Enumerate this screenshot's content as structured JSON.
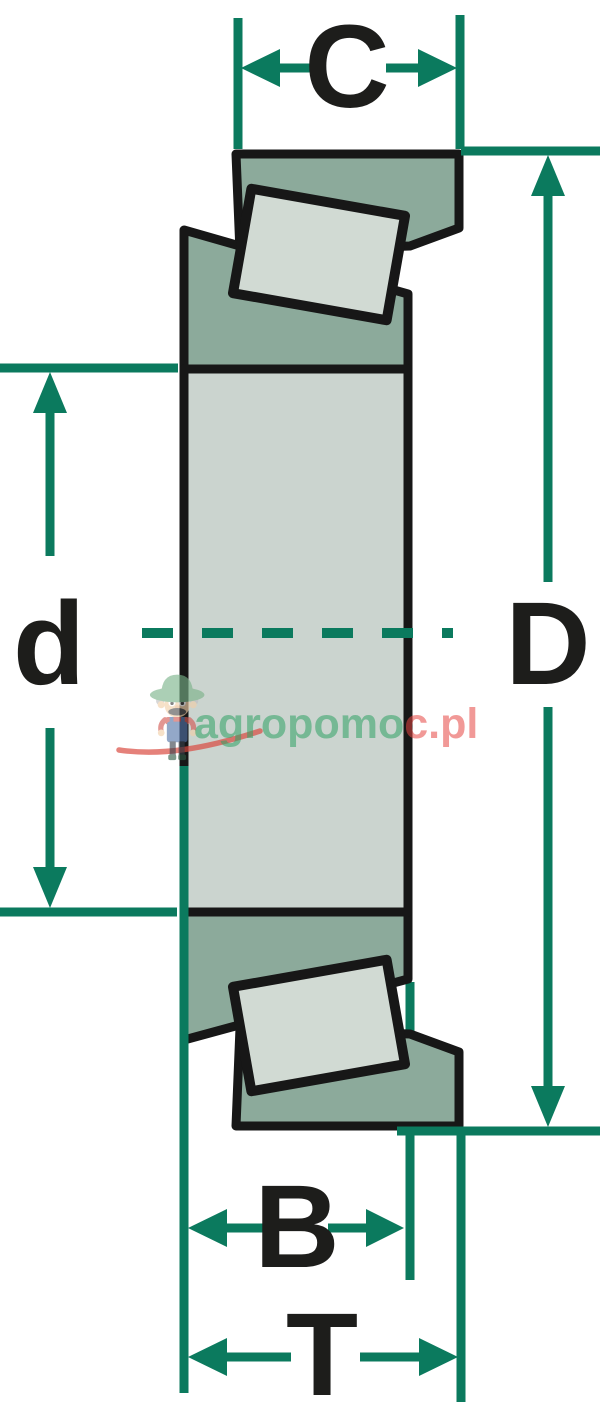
{
  "diagram": {
    "dimension_labels": {
      "cup_width": "C",
      "outer_diameter": "D",
      "bore_diameter": "d",
      "inner_ring_width": "B",
      "total_width": "T"
    }
  },
  "watermark": {
    "brand_green": "agropomo",
    "brand_red": "c.pl",
    "brand_full": "agropomoc.pl"
  },
  "colors": {
    "dimension_green": "#0b7a5e",
    "outline_black": "#171717",
    "ring_fill_dark": "#8caa9b",
    "ring_fill_light": "#cbd4cf",
    "roller_fill": "#d1dad3",
    "watermark_green": "#85c79f",
    "watermark_red": "#f0928f",
    "background": "#ffffff"
  }
}
